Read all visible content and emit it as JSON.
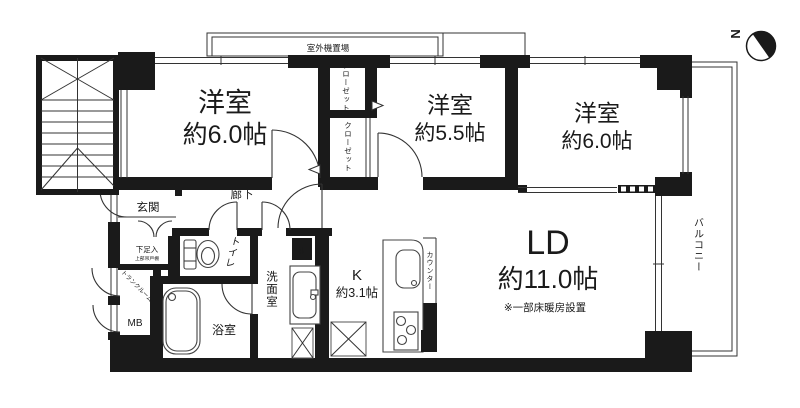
{
  "colors": {
    "wall": "#1a1a1a",
    "line": "#333333",
    "background": "#ffffff"
  },
  "compass": {
    "north": "N"
  },
  "exterior": {
    "outdoor_unit": "室外機置場",
    "balcony": "バルコニー"
  },
  "rooms": {
    "bedroom_left": {
      "name": "洋室",
      "size": "約6.0帖"
    },
    "bedroom_middle": {
      "name": "洋室",
      "size": "約5.5帖"
    },
    "bedroom_right": {
      "name": "洋室",
      "size": "約6.0帖"
    },
    "living_dining": {
      "name": "LD",
      "size": "約11.0帖",
      "note": "※一部床暖房設置"
    },
    "kitchen": {
      "name": "K",
      "size": "約3.1帖"
    },
    "entrance": {
      "name": "玄関"
    },
    "hallway": {
      "name": "廊下"
    },
    "toilet": {
      "name": "トイレ"
    },
    "washroom": {
      "name": "洗面室"
    },
    "bathroom": {
      "name": "浴室"
    }
  },
  "storage": {
    "closet_upper": "クローゼット",
    "closet_lower": "クローゼット",
    "shoe_box": "下足入",
    "shoe_box_note": "上部吊戸棚",
    "trunk_room": "トランクルーム",
    "meter_box": "MB",
    "shelf": "棚",
    "pipe_space": "PS",
    "counter": "カウンター"
  }
}
